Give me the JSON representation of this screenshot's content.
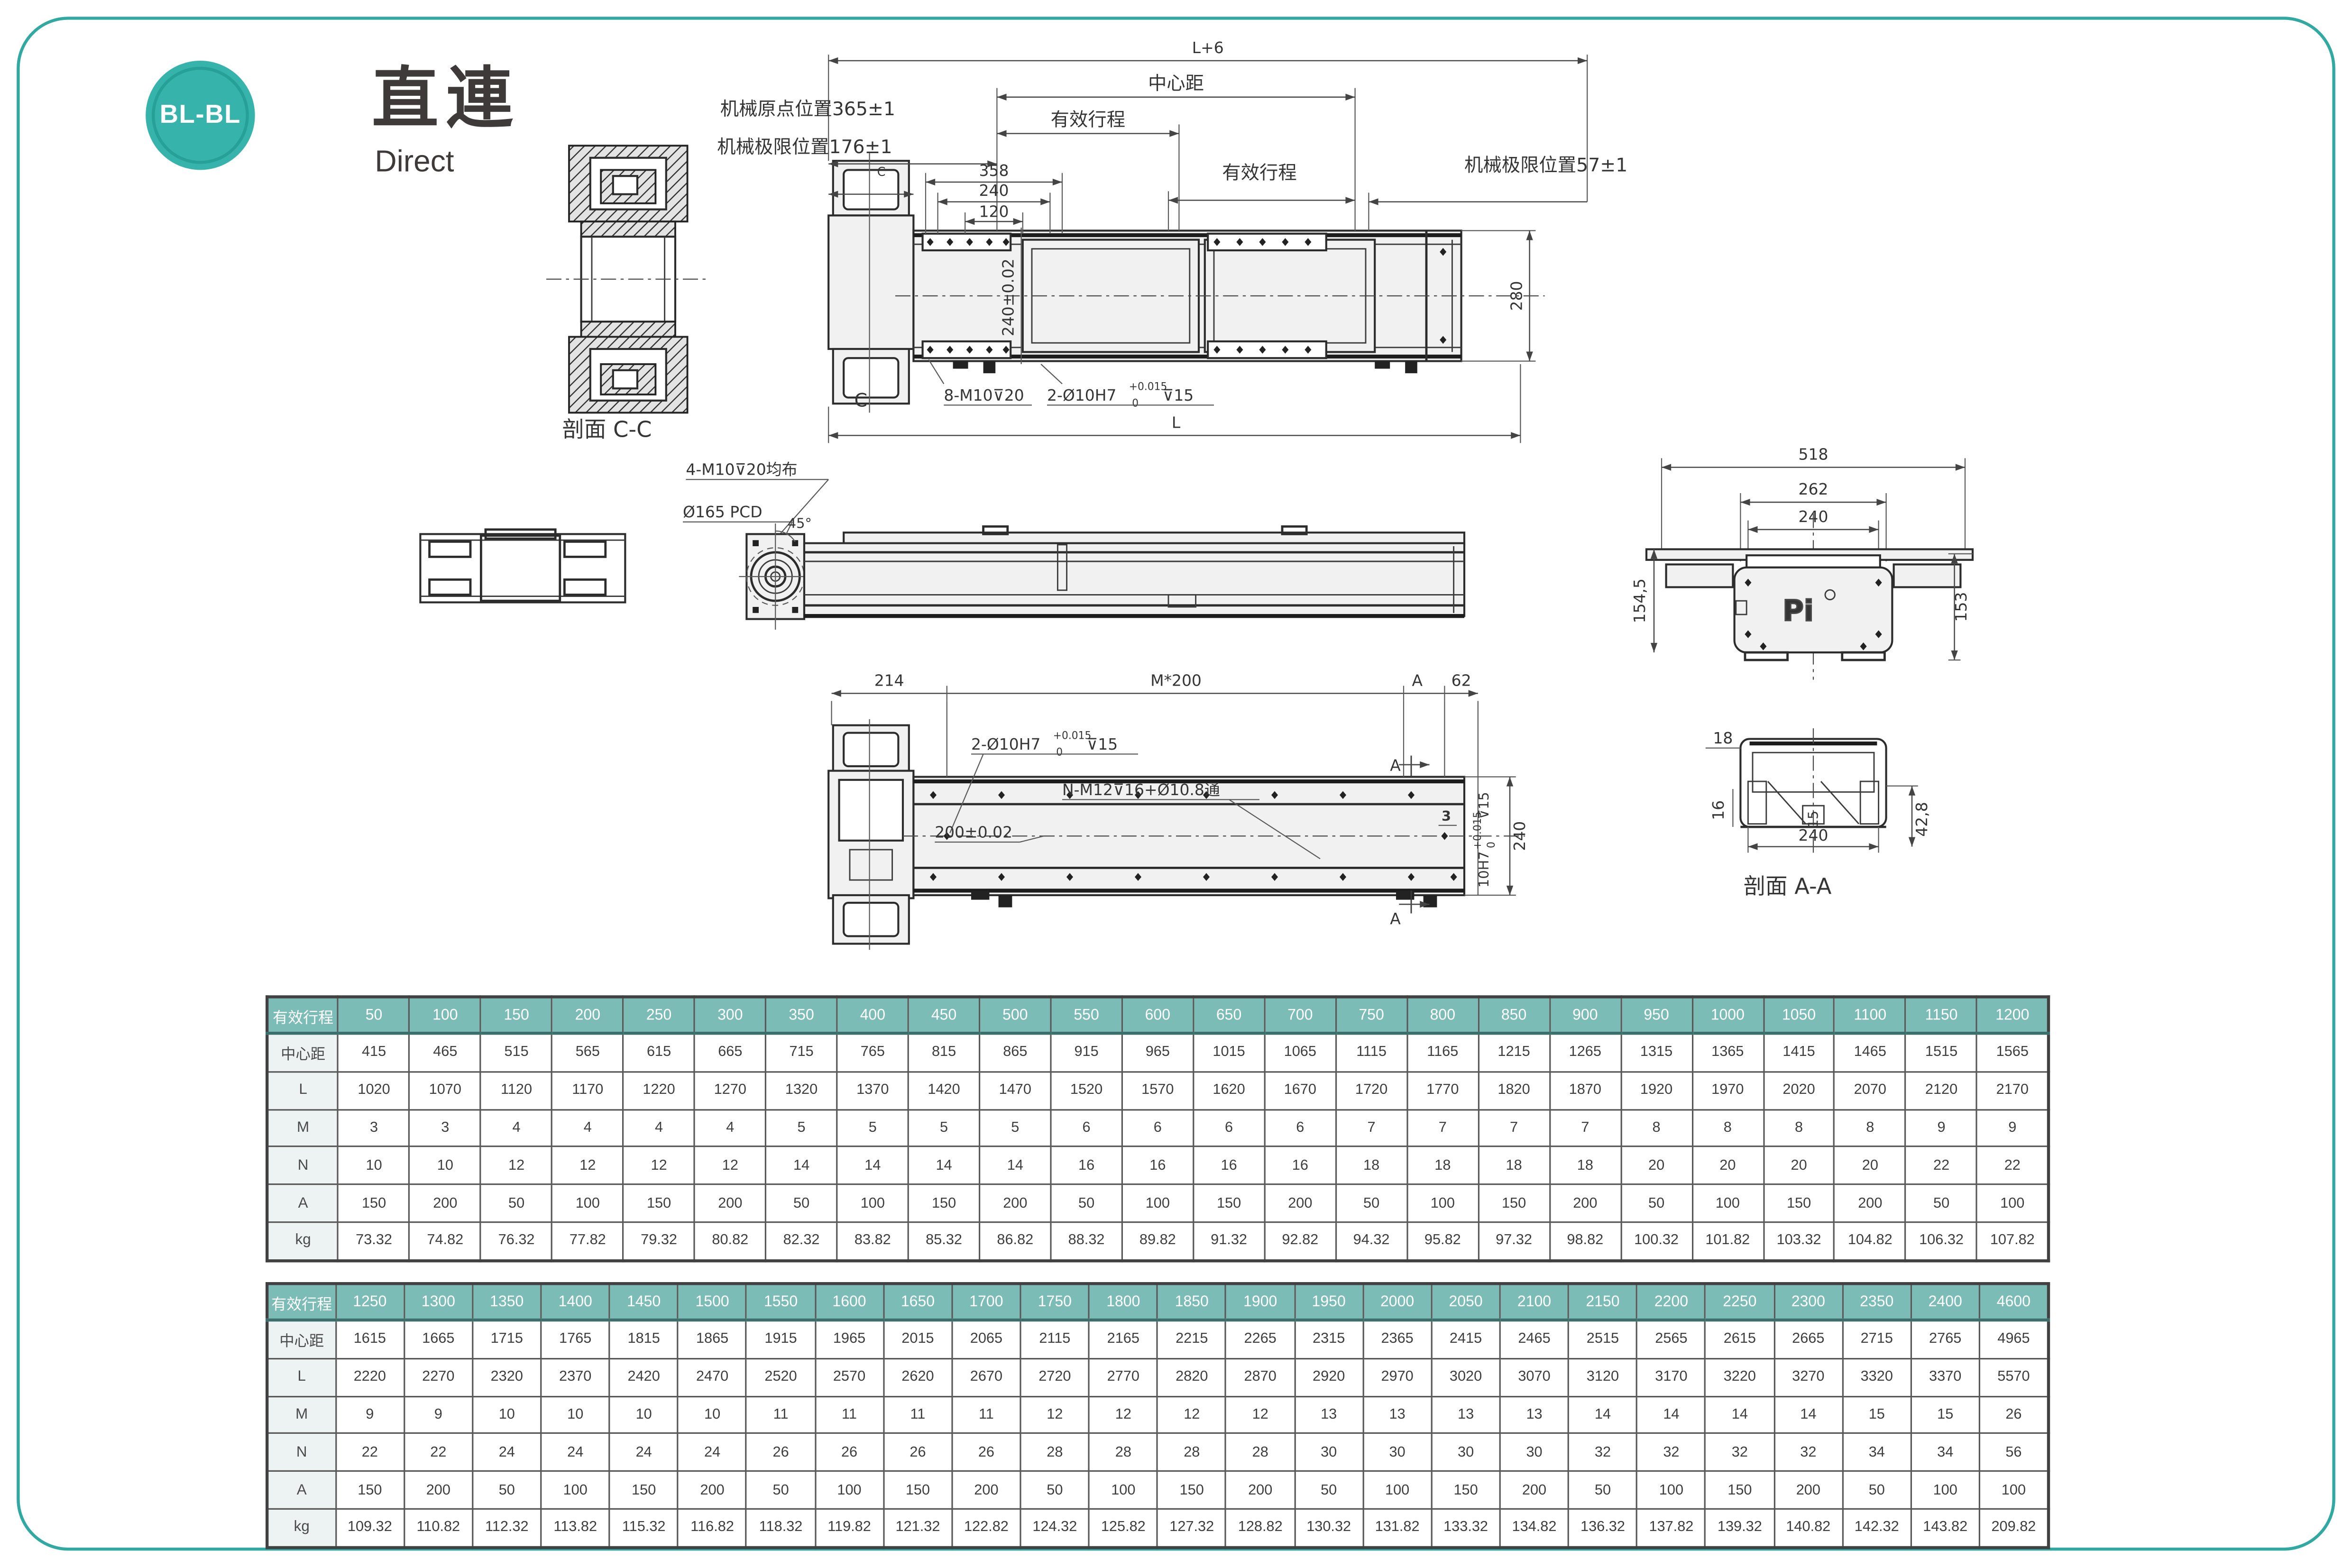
{
  "page": {
    "badge_label": "BL-BL",
    "title": "直連",
    "subtitle": "Direct"
  },
  "colors": {
    "teal_frame": "#2fa9a1",
    "badge_teal": "#36b3ab",
    "table_header_teal": "#7cbcb7",
    "table_label_bg": "#edf3f2",
    "line": "#3c3c3c"
  },
  "drawing": {
    "section_cc_label": "剖面 C-C",
    "section_aa_label": "剖面 A-A",
    "dim_l6": "L+6",
    "dim_center_distance": "中心距",
    "dim_stroke_left": "有效行程",
    "dim_stroke_right": "有效行程",
    "origin_pos": "机械原点位置365±1",
    "limit_left": "机械极限位置176±1",
    "limit_right": "机械极限位置57±1",
    "dim_358": "358",
    "dim_240_a": "240",
    "dim_120": "120",
    "dim_240_tol": "240±0.02",
    "dim_280": "280",
    "note_8m10": "8-M10⊽20",
    "note_2holes": "2-Ø10H7",
    "tol_sup": "+0.015",
    "tol_sub": "0",
    "depth_15": "⊽15",
    "dim_L": "L",
    "c_mark": "C",
    "note_4m10": "4-M10⊽20均布",
    "note_pcd": "Ø165 PCD",
    "angle_45": "45°",
    "dim_518": "518",
    "dim_262": "262",
    "dim_240_b": "240",
    "dim_154_5": "154,5",
    "dim_153": "153",
    "logo_pi": "Pi",
    "dim_214": "214",
    "dim_m200": "M*200",
    "a_mark": "A",
    "dim_62": "62",
    "note_nm12": "N-M12⊽16+Ø10.8通",
    "dim_200_tol": "200±0.02",
    "side_hole_note": "10H7",
    "dim_240_c": "240",
    "dim_3": "3",
    "dim_18": "18",
    "dim_16": "16",
    "dim_15": "15",
    "dim_240_d": "240",
    "dim_42_8": "42,8"
  },
  "tables": [
    {
      "header_label": "有效行程",
      "header_values": [
        "50",
        "100",
        "150",
        "200",
        "250",
        "300",
        "350",
        "400",
        "450",
        "500",
        "550",
        "600",
        "650",
        "700",
        "750",
        "800",
        "850",
        "900",
        "950",
        "1000",
        "1050",
        "1100",
        "1150",
        "1200"
      ],
      "rows": [
        {
          "label": "中心距",
          "values": [
            "415",
            "465",
            "515",
            "565",
            "615",
            "665",
            "715",
            "765",
            "815",
            "865",
            "915",
            "965",
            "1015",
            "1065",
            "1115",
            "1165",
            "1215",
            "1265",
            "1315",
            "1365",
            "1415",
            "1465",
            "1515",
            "1565"
          ]
        },
        {
          "label": "L",
          "values": [
            "1020",
            "1070",
            "1120",
            "1170",
            "1220",
            "1270",
            "1320",
            "1370",
            "1420",
            "1470",
            "1520",
            "1570",
            "1620",
            "1670",
            "1720",
            "1770",
            "1820",
            "1870",
            "1920",
            "1970",
            "2020",
            "2070",
            "2120",
            "2170"
          ]
        },
        {
          "label": "M",
          "values": [
            "3",
            "3",
            "4",
            "4",
            "4",
            "4",
            "5",
            "5",
            "5",
            "5",
            "6",
            "6",
            "6",
            "6",
            "7",
            "7",
            "7",
            "7",
            "8",
            "8",
            "8",
            "8",
            "9",
            "9"
          ]
        },
        {
          "label": "N",
          "values": [
            "10",
            "10",
            "12",
            "12",
            "12",
            "12",
            "14",
            "14",
            "14",
            "14",
            "16",
            "16",
            "16",
            "16",
            "18",
            "18",
            "18",
            "18",
            "20",
            "20",
            "20",
            "20",
            "22",
            "22"
          ]
        },
        {
          "label": "A",
          "values": [
            "150",
            "200",
            "50",
            "100",
            "150",
            "200",
            "50",
            "100",
            "150",
            "200",
            "50",
            "100",
            "150",
            "200",
            "50",
            "100",
            "150",
            "200",
            "50",
            "100",
            "150",
            "200",
            "50",
            "100"
          ]
        },
        {
          "label": "kg",
          "values": [
            "73.32",
            "74.82",
            "76.32",
            "77.82",
            "79.32",
            "80.82",
            "82.32",
            "83.82",
            "85.32",
            "86.82",
            "88.32",
            "89.82",
            "91.32",
            "92.82",
            "94.32",
            "95.82",
            "97.32",
            "98.82",
            "100.32",
            "101.82",
            "103.32",
            "104.82",
            "106.32",
            "107.82"
          ]
        }
      ]
    },
    {
      "header_label": "有效行程",
      "header_values": [
        "1250",
        "1300",
        "1350",
        "1400",
        "1450",
        "1500",
        "1550",
        "1600",
        "1650",
        "1700",
        "1750",
        "1800",
        "1850",
        "1900",
        "1950",
        "2000",
        "2050",
        "2100",
        "2150",
        "2200",
        "2250",
        "2300",
        "2350",
        "2400",
        "4600"
      ],
      "rows": [
        {
          "label": "中心距",
          "values": [
            "1615",
            "1665",
            "1715",
            "1765",
            "1815",
            "1865",
            "1915",
            "1965",
            "2015",
            "2065",
            "2115",
            "2165",
            "2215",
            "2265",
            "2315",
            "2365",
            "2415",
            "2465",
            "2515",
            "2565",
            "2615",
            "2665",
            "2715",
            "2765",
            "4965"
          ]
        },
        {
          "label": "L",
          "values": [
            "2220",
            "2270",
            "2320",
            "2370",
            "2420",
            "2470",
            "2520",
            "2570",
            "2620",
            "2670",
            "2720",
            "2770",
            "2820",
            "2870",
            "2920",
            "2970",
            "3020",
            "3070",
            "3120",
            "3170",
            "3220",
            "3270",
            "3320",
            "3370",
            "5570"
          ]
        },
        {
          "label": "M",
          "values": [
            "9",
            "9",
            "10",
            "10",
            "10",
            "10",
            "11",
            "11",
            "11",
            "11",
            "12",
            "12",
            "12",
            "12",
            "13",
            "13",
            "13",
            "13",
            "14",
            "14",
            "14",
            "14",
            "15",
            "15",
            "26"
          ]
        },
        {
          "label": "N",
          "values": [
            "22",
            "22",
            "24",
            "24",
            "24",
            "24",
            "26",
            "26",
            "26",
            "26",
            "28",
            "28",
            "28",
            "28",
            "30",
            "30",
            "30",
            "30",
            "32",
            "32",
            "32",
            "32",
            "34",
            "34",
            "56"
          ]
        },
        {
          "label": "A",
          "values": [
            "150",
            "200",
            "50",
            "100",
            "150",
            "200",
            "50",
            "100",
            "150",
            "200",
            "50",
            "100",
            "150",
            "200",
            "50",
            "100",
            "150",
            "200",
            "50",
            "100",
            "150",
            "200",
            "50",
            "100",
            "100"
          ]
        },
        {
          "label": "kg",
          "values": [
            "109.32",
            "110.82",
            "112.32",
            "113.82",
            "115.32",
            "116.82",
            "118.32",
            "119.82",
            "121.32",
            "122.82",
            "124.32",
            "125.82",
            "127.32",
            "128.82",
            "130.32",
            "131.82",
            "133.32",
            "134.82",
            "136.32",
            "137.82",
            "139.32",
            "140.82",
            "142.32",
            "143.82",
            "209.82"
          ]
        }
      ]
    }
  ]
}
